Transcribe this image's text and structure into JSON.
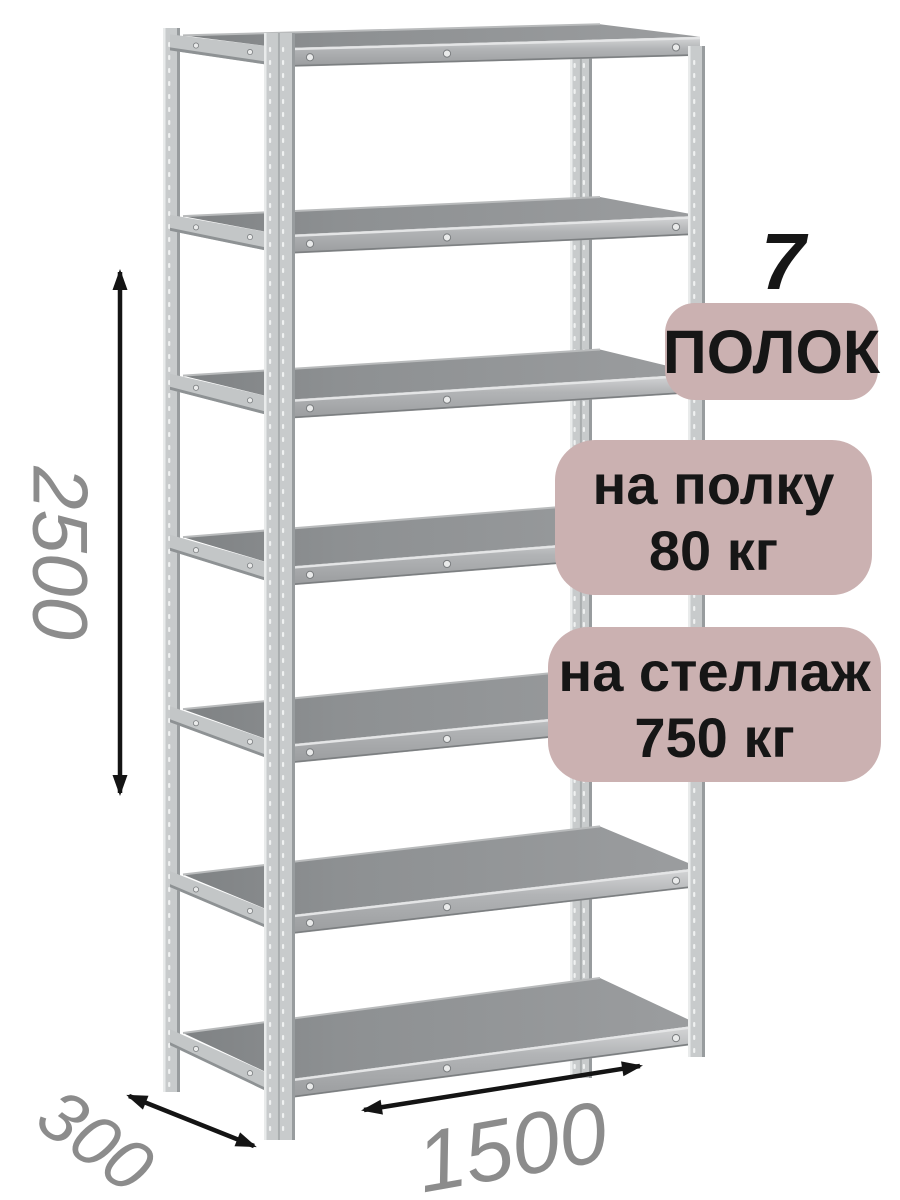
{
  "product": {
    "shelf_count_display": "7",
    "badges": [
      {
        "id": "shelf-count",
        "lines": [
          "ПОЛОК"
        ]
      },
      {
        "id": "per-shelf-load",
        "lines": [
          "на полку",
          "80 кг"
        ]
      },
      {
        "id": "per-rack-load",
        "lines": [
          "на стеллаж",
          "750 кг"
        ]
      }
    ],
    "dimensions": {
      "height_mm": "2500",
      "depth_mm": "300",
      "width_mm": "1500"
    }
  },
  "icons": {
    "height_arrow": "double-headed-vertical-arrow",
    "depth_arrow": "double-headed-diagonal-arrow",
    "width_arrow": "double-headed-horizontal-arrow"
  },
  "colors": {
    "page_bg": "#ffffff",
    "badge_bg": "#cbb1b1",
    "badge_text": "#161616",
    "dimension_text": "#8c8c8c",
    "arrow": "#141414",
    "metal_face": "#c8cbcc",
    "metal_highlight": "#e9ebeb",
    "metal_shadow": "#989c9e",
    "shelf_top": "#939597",
    "shelf_front": "#aaacae"
  }
}
